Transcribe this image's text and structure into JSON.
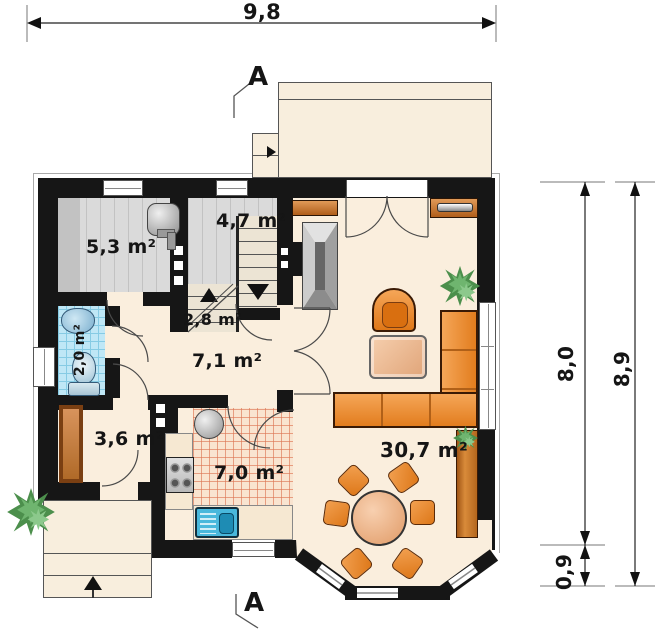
{
  "plan": {
    "rooms": [
      {
        "id": "boiler-room",
        "area": "5,3 m²"
      },
      {
        "id": "storage",
        "area": "4,7 m²"
      },
      {
        "id": "stair-landing",
        "area": "2,8 m²"
      },
      {
        "id": "hall",
        "area": "7,1 m²"
      },
      {
        "id": "wc",
        "area": "2,0 m²"
      },
      {
        "id": "vestibule",
        "area": "3,6 m²"
      },
      {
        "id": "kitchen",
        "area": "7,0 m²"
      },
      {
        "id": "living-room",
        "area": "30,7 m²"
      }
    ],
    "dimensions": {
      "top_width": "9,8",
      "side_main": "8,0",
      "side_total": "8,9",
      "side_bay": "0,9"
    },
    "section_marks": {
      "top": "A",
      "bottom": "A"
    },
    "colors": {
      "wall": "#161616",
      "floor": "#faeedd",
      "gray_floor": "#dadada",
      "wc_tile": "#bfe7f6",
      "kitchen_tile_line": "#dd7755",
      "furniture_orange": "#e8872e",
      "wood": "#c8762a",
      "sink_blue": "#49b8dc",
      "plant_green": "#5ea35e"
    }
  }
}
